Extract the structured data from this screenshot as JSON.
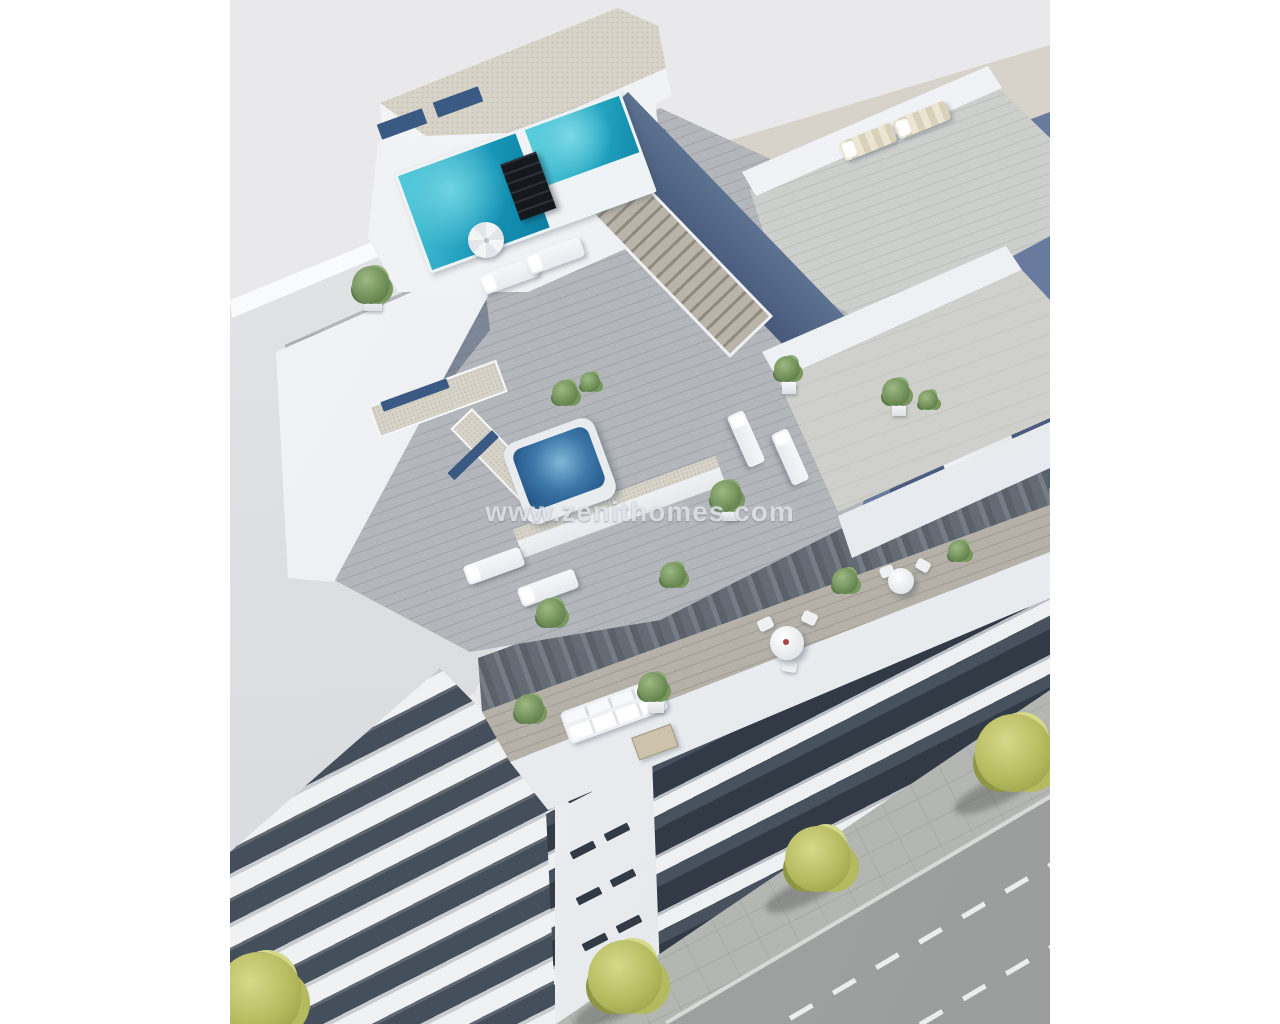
{
  "watermark": {
    "text": "www.zenithomes.com"
  },
  "palette": {
    "sky": "#e9e9eb",
    "beige": "#d9d4cc",
    "shadow_blue": "#5e7299",
    "navy_wall": "#53648b",
    "facade_dark": "#454e5b",
    "glass_dark": "#323a46",
    "glass_blue": "#3a5a84",
    "curtain": "#5a6169",
    "curtain_light": "#757c85",
    "gravel": "#d7d3c9",
    "gravel_dot": "#c6c1b4",
    "deck_light": "#b3b6ba",
    "deck_seam": "#a0a4a9",
    "deck_warm": "#b5b1a8",
    "deck_warm_seam": "#a19c92",
    "pool_light": "#4cc7da",
    "pool_deep": "#0d7fa2",
    "jacuzzi_light": "#7fb7d8",
    "jacuzzi_deep": "#1c4d7e",
    "asphalt": "#9b9d9d",
    "sidewalk": "#b4b6b2",
    "curb": "#dddedb",
    "tree_light": "#d6d98a",
    "tree_mid": "#b5ba5e",
    "tree_dark": "#8f9643",
    "plant_light": "#9db984",
    "plant_dark": "#4d6a3e",
    "lounger_cream": "#ece5d2",
    "watermark": "#dfe3e8"
  },
  "scene": {
    "type": "aerial-3d-architectural-render",
    "objects": [
      "white apartment building",
      "rooftop swimming pool",
      "pool chimney",
      "gravel roof",
      "roof stairs",
      "jacuzzi",
      "sun loungers",
      "parasols",
      "potted plants",
      "rooftop dining set",
      "attic terrace sofa",
      "attic dining tables",
      "balcony band facade",
      "stair core with slit windows",
      "neighboring building",
      "cast building shadow",
      "sidewalk",
      "street with dashed lane markings",
      "street trees"
    ]
  }
}
